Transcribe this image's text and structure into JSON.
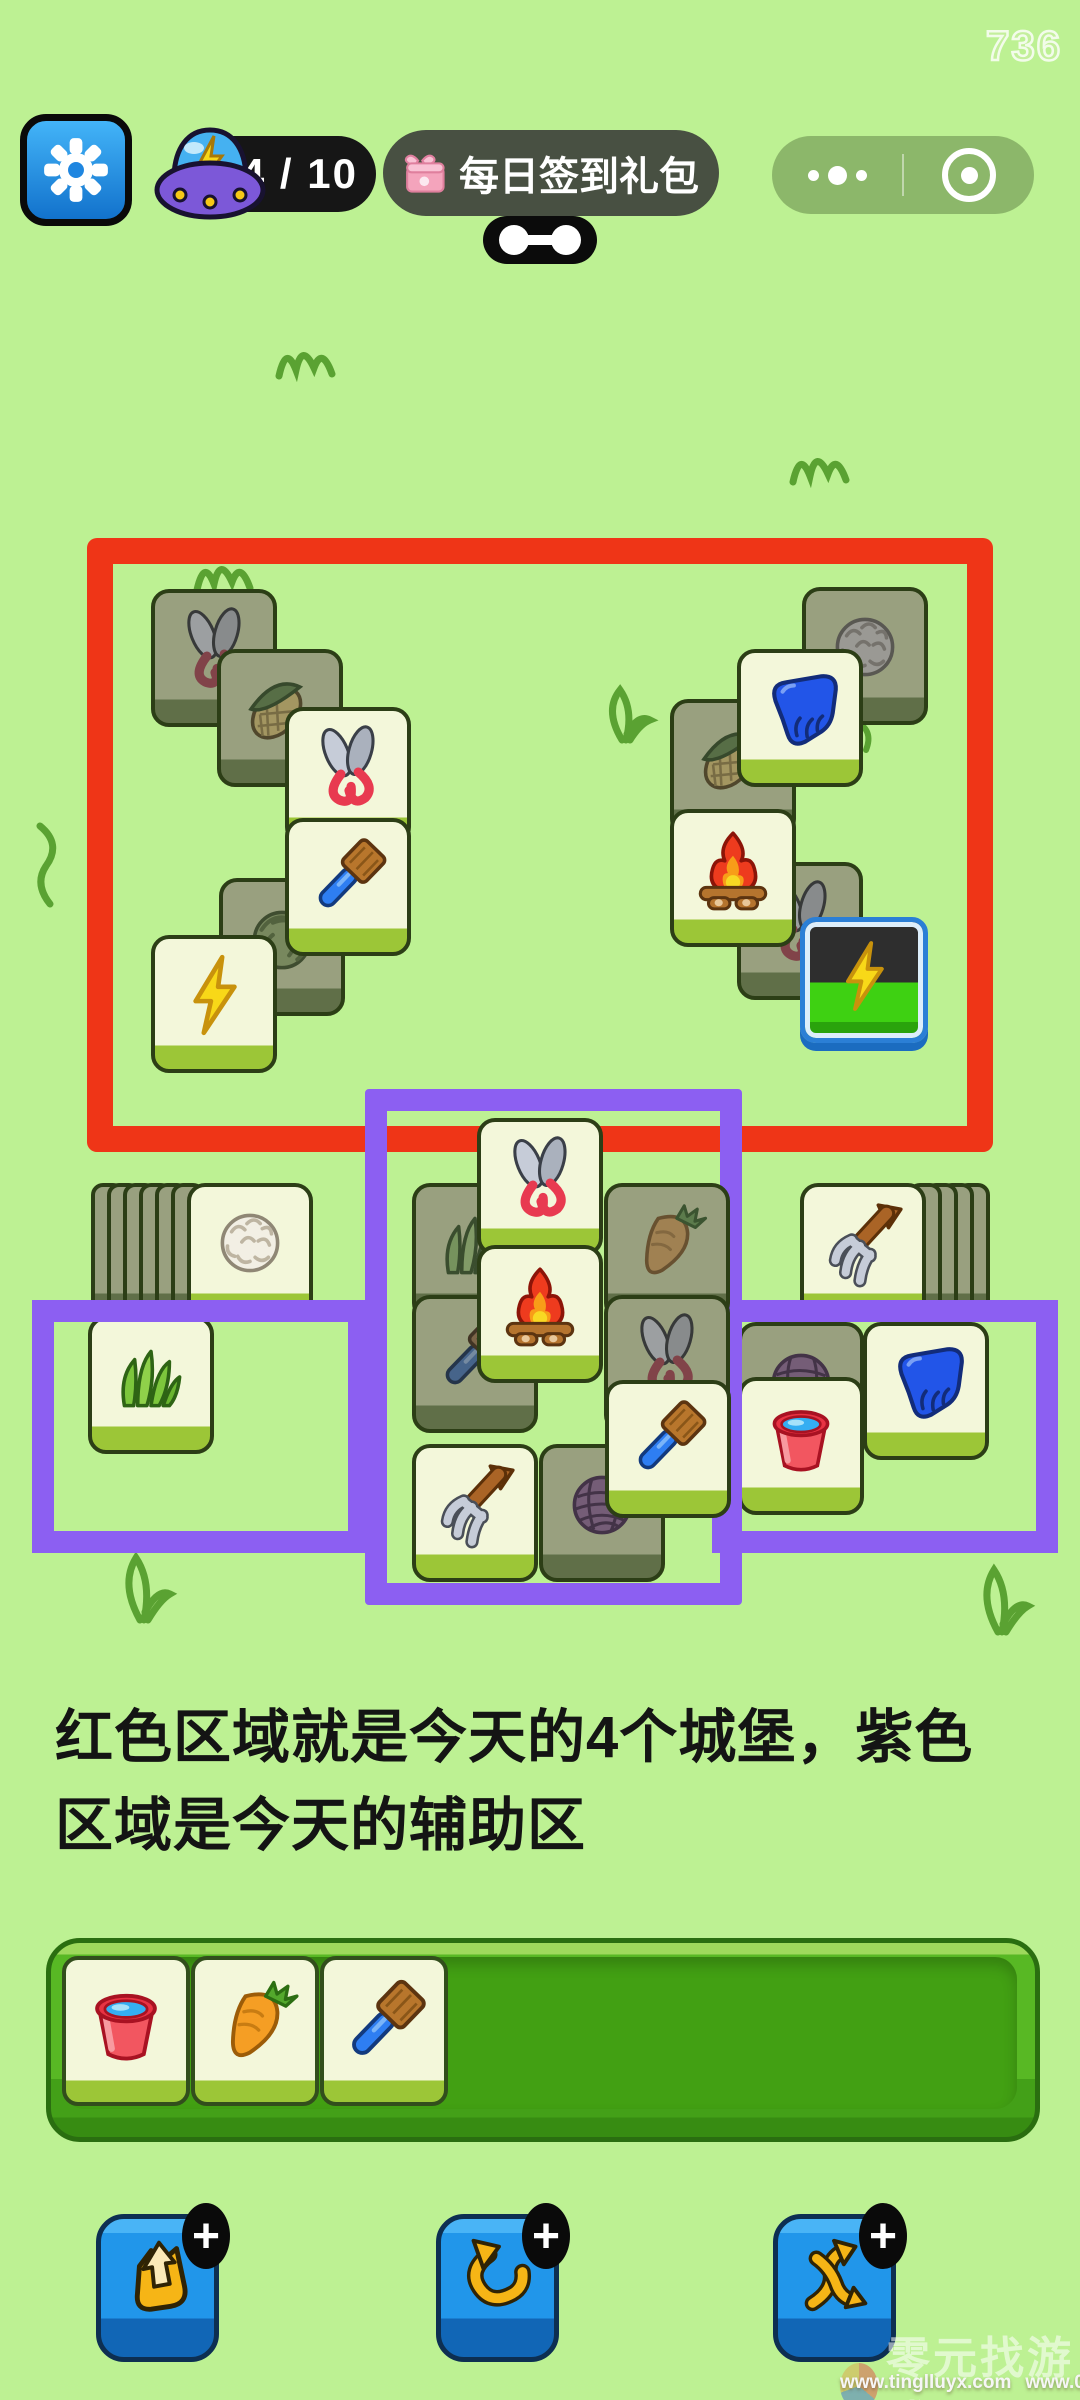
{
  "window": {
    "overlay_number": "736",
    "bg_color": "#bdf193"
  },
  "top_bar": {
    "settings_button": {
      "icon": "gear-icon"
    },
    "energy_counter": {
      "icon": "ufo-icon",
      "value": "4 / 10"
    },
    "daily_gift_button": {
      "icon": "gift-icon",
      "label": "每日签到礼包"
    },
    "drag_handle": {
      "icon": "link-icon"
    },
    "mini_program_capsule": {
      "more_icon": "more-dots-icon",
      "exit_icon": "circle-target-icon"
    }
  },
  "annotations": {
    "castle_zone_color": "#ef3517",
    "helper_zone_color": "#8c5ff2",
    "caption_line1": "红色区域就是今天的4个城堡，紫色",
    "caption_line2": "区域是今天的辅助区"
  },
  "board": {
    "castle_tiles": [
      {
        "icon": "shears",
        "state": "covered",
        "x": 151,
        "y": 589
      },
      {
        "icon": "corn",
        "state": "covered",
        "x": 217,
        "y": 649
      },
      {
        "icon": "cabbage",
        "state": "covered",
        "x": 219,
        "y": 878
      },
      {
        "icon": "lightning",
        "state": "free",
        "x": 151,
        "y": 935
      },
      {
        "icon": "shears",
        "state": "free",
        "x": 285,
        "y": 707
      },
      {
        "icon": "brush",
        "state": "free",
        "x": 285,
        "y": 818
      },
      {
        "icon": "wool",
        "state": "covered",
        "x": 802,
        "y": 587
      },
      {
        "icon": "corn",
        "state": "covered",
        "x": 670,
        "y": 699
      },
      {
        "icon": "shears",
        "state": "covered",
        "x": 737,
        "y": 862
      },
      {
        "icon": "glove",
        "state": "free",
        "x": 737,
        "y": 649
      },
      {
        "icon": "campfire",
        "state": "free",
        "x": 670,
        "y": 809
      },
      {
        "icon": "lightning",
        "state": "special",
        "x": 800,
        "y": 917
      }
    ],
    "helper_tiles": [
      {
        "icon": "grass",
        "state": "covered",
        "x": 412,
        "y": 1183
      },
      {
        "icon": "carrot",
        "state": "covered",
        "x": 604,
        "y": 1183
      },
      {
        "icon": "brush",
        "state": "covered",
        "x": 412,
        "y": 1295
      },
      {
        "icon": "shears",
        "state": "covered",
        "x": 604,
        "y": 1295
      },
      {
        "icon": "shears",
        "state": "free",
        "x": 477,
        "y": 1118
      },
      {
        "icon": "campfire",
        "state": "free",
        "x": 477,
        "y": 1245
      },
      {
        "icon": "yarn",
        "state": "covered",
        "x": 539,
        "y": 1444
      },
      {
        "icon": "pitchfork",
        "state": "free",
        "x": 412,
        "y": 1444
      },
      {
        "icon": "brush",
        "state": "free",
        "x": 605,
        "y": 1380
      }
    ],
    "side_tiles": [
      {
        "icon": "grass",
        "state": "free",
        "x": 88,
        "y": 1316
      },
      {
        "icon": "yarn",
        "state": "covered",
        "x": 738,
        "y": 1322
      },
      {
        "icon": "glove",
        "state": "free",
        "x": 863,
        "y": 1322
      },
      {
        "icon": "bucket",
        "state": "free",
        "x": 738,
        "y": 1377
      }
    ],
    "stacks": [
      {
        "icon": "cotton",
        "x": 187,
        "y": 1183,
        "hidden_count": 6,
        "fan": "left"
      },
      {
        "icon": "pitchfork",
        "x": 800,
        "y": 1183,
        "hidden_count": 4,
        "fan": "right"
      }
    ]
  },
  "tray": {
    "tiles": [
      "bucket",
      "carrot",
      "brush"
    ]
  },
  "powerups": [
    {
      "name": "move-out",
      "icon": "pouch-arrow-icon",
      "badge": "+"
    },
    {
      "name": "undo",
      "icon": "undo-arrow-icon",
      "badge": "+"
    },
    {
      "name": "shuffle",
      "icon": "shuffle-arrows-icon",
      "badge": "+"
    }
  ],
  "watermark": {
    "logo_text": "零元找游戏",
    "url_left": "www.tinglluyx.com",
    "url_right": "www.06zyx.com"
  }
}
